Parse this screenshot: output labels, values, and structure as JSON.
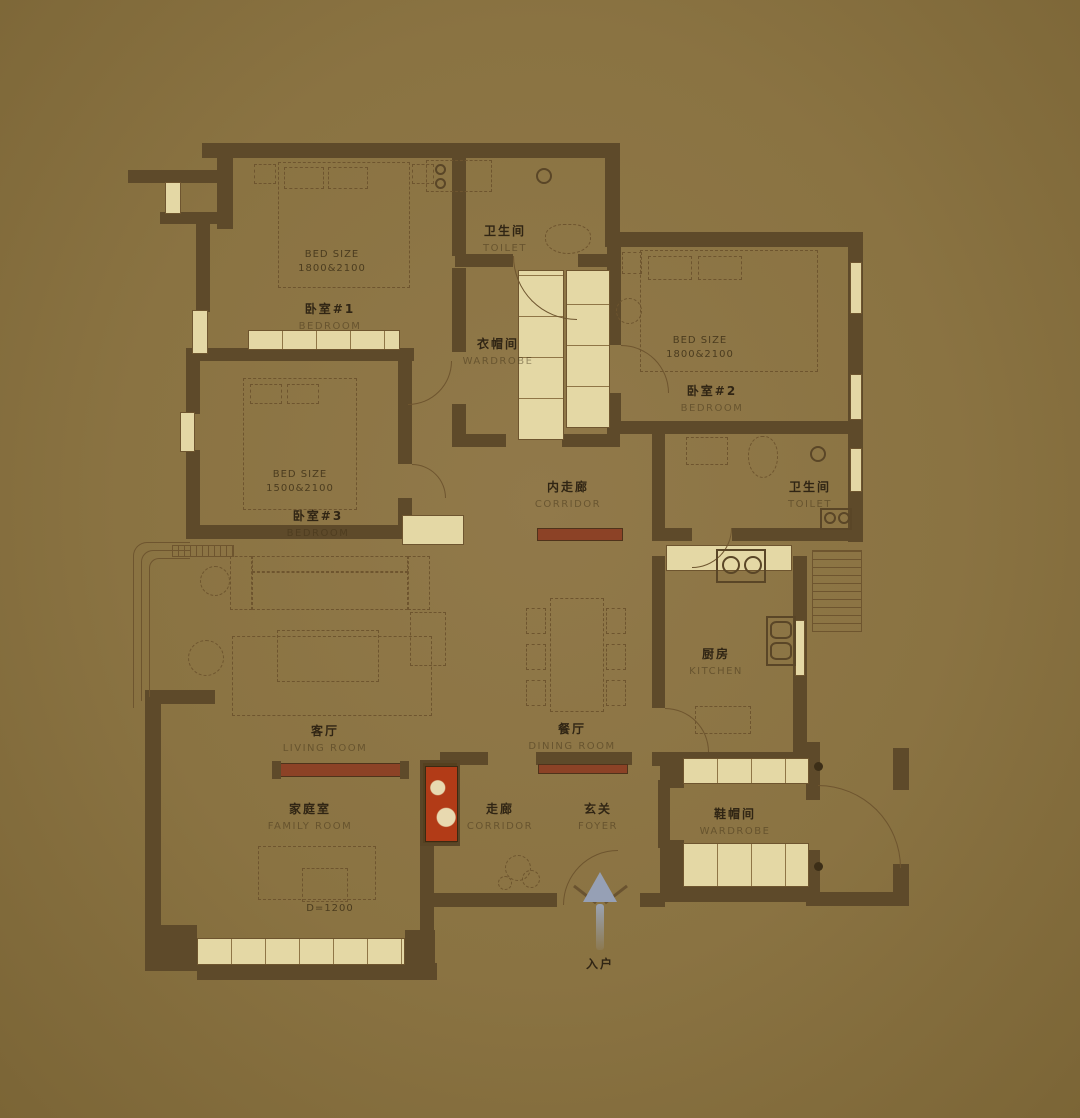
{
  "plan": {
    "rooms": [
      {
        "id": "bedroom-1",
        "zh": "卧室#1",
        "en": "BEDROOM"
      },
      {
        "id": "toilet-1",
        "zh": "卫生间",
        "en": "TOILET"
      },
      {
        "id": "walkin-wardrobe",
        "zh": "衣帽间",
        "en": "WARDROBE"
      },
      {
        "id": "bedroom-2",
        "zh": "卧室#2",
        "en": "BEDROOM"
      },
      {
        "id": "bedroom-3",
        "zh": "卧室#3",
        "en": "BEDROOM"
      },
      {
        "id": "inner-corridor",
        "zh": "内走廊",
        "en": "CORRIDOR"
      },
      {
        "id": "toilet-2",
        "zh": "卫生间",
        "en": "TOILET"
      },
      {
        "id": "kitchen",
        "zh": "厨房",
        "en": "KITCHEN"
      },
      {
        "id": "living-room",
        "zh": "客厅",
        "en": "LIVING ROOM"
      },
      {
        "id": "dining-room",
        "zh": "餐厅",
        "en": "DINING ROOM"
      },
      {
        "id": "family-room",
        "zh": "家庭室",
        "en": "FAMILY ROOM"
      },
      {
        "id": "corridor",
        "zh": "走廊",
        "en": "CORRIDOR"
      },
      {
        "id": "foyer",
        "zh": "玄关",
        "en": "FOYER"
      },
      {
        "id": "shoe-wardrobe",
        "zh": "鞋帽间",
        "en": "WARDROBE"
      }
    ],
    "annotations": {
      "bed1": {
        "line1": "BED SIZE",
        "line2": "1800&2100"
      },
      "bed2": {
        "line1": "BED SIZE",
        "line2": "1800&2100"
      },
      "bed3": {
        "line1": "BED SIZE",
        "line2": "1500&2100"
      },
      "family_table": "D=1200",
      "entry": "入户"
    },
    "colors": {
      "background": "#8a7342",
      "wall": "#5e4a2a",
      "window": "#e4d8a5",
      "accent_red": "#8c4226",
      "cabinet_red": "#b23b17",
      "arrow": "#96a0b5"
    }
  }
}
